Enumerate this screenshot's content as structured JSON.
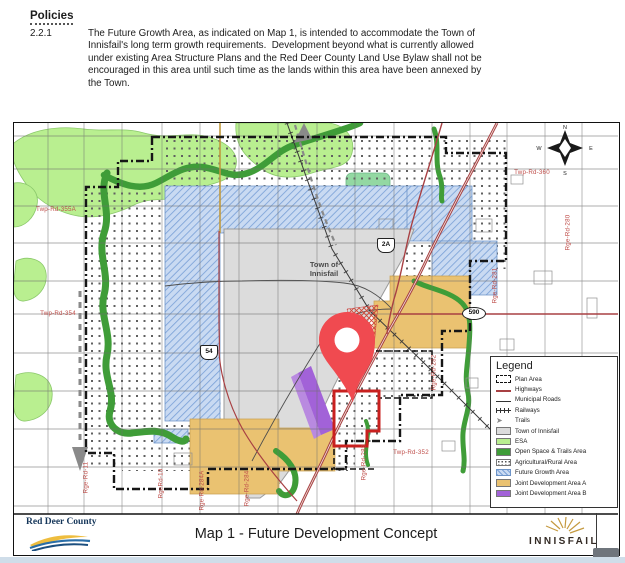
{
  "document": {
    "heading": "Policies",
    "clause_number": "2.2.1",
    "clause_text": "The Future Growth Area, as indicated on Map 1, is intended to accommodate the Town of Innisfail's long term growth requirements.  Development beyond what is currently allowed under existing Area Structure Plans and the Red Deer County Land Use Bylaw shall not be encouraged in this area until such time as the lands within this area have been annexed by the Town."
  },
  "map": {
    "town_label": {
      "line1": "Town of",
      "line2": "Innisfail"
    },
    "compass": {
      "n": "N",
      "e": "E",
      "s": "S",
      "w": "W"
    },
    "highway_shields": [
      {
        "label": "2A",
        "shape": "badge",
        "x": 371,
        "y": 121
      },
      {
        "label": "54",
        "shape": "badge",
        "x": 194,
        "y": 228
      },
      {
        "label": "590",
        "shape": "oval",
        "x": 459,
        "y": 190
      }
    ],
    "road_labels": [
      {
        "text": "Twp-Rd-360",
        "x": 518,
        "y": 50,
        "vertical": false
      },
      {
        "text": "Twp-Rd-355A",
        "x": 42,
        "y": 87,
        "vertical": false
      },
      {
        "text": "Twp-Rd-354",
        "x": 44,
        "y": 191,
        "vertical": false
      },
      {
        "text": "Twp-Rd-352",
        "x": 397,
        "y": 330,
        "vertical": false
      },
      {
        "text": "Rge-Rd-280",
        "x": 554,
        "y": 110,
        "vertical": true
      },
      {
        "text": "Rge-Rd-281",
        "x": 481,
        "y": 163,
        "vertical": true
      },
      {
        "text": "Rge-Rd-282",
        "x": 420,
        "y": 250,
        "vertical": true
      },
      {
        "text": "Rge-Rd-283",
        "x": 350,
        "y": 340,
        "vertical": true
      },
      {
        "text": "Rge-Rd-284",
        "x": 233,
        "y": 366,
        "vertical": true
      },
      {
        "text": "Rge-Rd-284A",
        "x": 188,
        "y": 368,
        "vertical": true
      },
      {
        "text": "RgeRd-10",
        "x": 147,
        "y": 361,
        "vertical": true
      },
      {
        "text": "Rge-Rd-11",
        "x": 72,
        "y": 355,
        "vertical": true
      }
    ],
    "legend": {
      "title": "Legend",
      "items": [
        {
          "label": "Plan Area",
          "type": "plan"
        },
        {
          "label": "Highways",
          "type": "highway"
        },
        {
          "label": "Municipal Roads",
          "type": "road"
        },
        {
          "label": "Railways",
          "type": "rail"
        },
        {
          "label": "Trails",
          "type": "trail"
        },
        {
          "label": "Town of Innisfail",
          "type": "swatch",
          "color": "#dcdcdc"
        },
        {
          "label": "ESA",
          "type": "swatch",
          "color": "#b9ef90"
        },
        {
          "label": "Open Space & Trails Area",
          "type": "swatch",
          "color": "#3f9d38"
        },
        {
          "label": "Agricultural/Rural Area",
          "type": "dots"
        },
        {
          "label": "Future Growth Area",
          "type": "hatch"
        },
        {
          "label": "Joint Development Area A",
          "type": "swatch",
          "color": "#eac271"
        },
        {
          "label": "Joint Development Area B",
          "type": "swatch",
          "color": "#a262d8"
        }
      ]
    },
    "footer": {
      "county_name": "Red Deer County",
      "map_title": "Map 1 - Future Development Concept",
      "town_name": "INNISFAIL"
    },
    "colors": {
      "esa": "#b9ef90",
      "open_space": "#3f9d38",
      "town": "#dcdcdc",
      "growth_hatch": "#7ca2d8",
      "jda_a": "#eac271",
      "jda_b": "#a262d8",
      "highway": "#a84043",
      "label_red": "#bf4e4a",
      "pin": "#f04a50",
      "selection": "#c9201f"
    }
  }
}
